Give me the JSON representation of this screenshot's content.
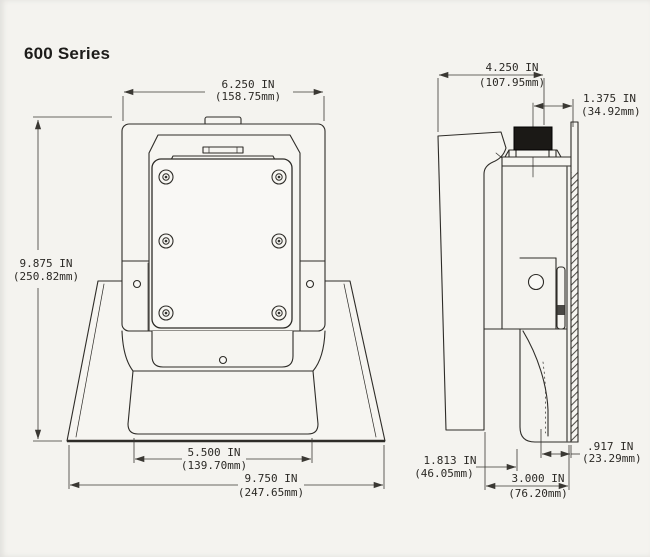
{
  "page": {
    "title": "600 Series"
  },
  "front_view": {
    "dimensions": {
      "top_width": {
        "in": "6.250 IN",
        "mm": "(158.75mm)"
      },
      "overall_height": {
        "in": "9.875 IN",
        "mm": "(250.82mm)"
      },
      "louver_width": {
        "in": "5.500 IN",
        "mm": "(139.70mm)"
      },
      "base_width": {
        "in": "9.750 IN",
        "mm": "(247.65mm)"
      }
    }
  },
  "side_view": {
    "dimensions": {
      "overall_depth": {
        "in": "4.250 IN",
        "mm": "(107.95mm)"
      },
      "connector_offset": {
        "in": "1.375 IN",
        "mm": "(34.92mm)"
      },
      "bracket_offset": {
        "in": "1.813 IN",
        "mm": "(46.05mm)"
      },
      "body_depth": {
        "in": "3.000 IN",
        "mm": "(76.20mm)"
      },
      "pad_depth": {
        "in": ".917 IN",
        "mm": "(23.29mm)"
      }
    }
  }
}
